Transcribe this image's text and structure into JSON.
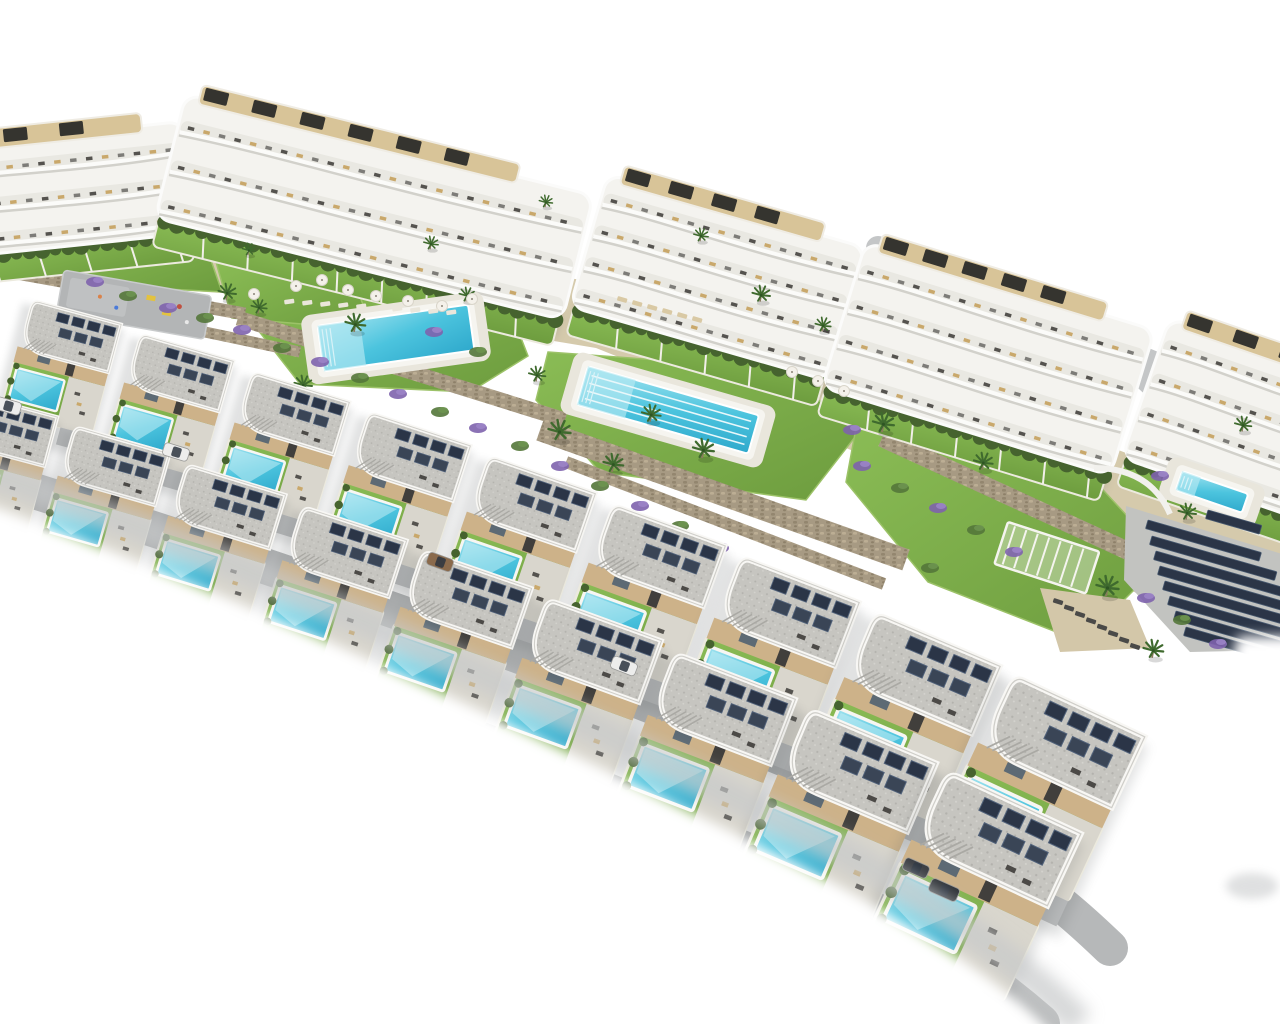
{
  "image": {
    "type": "aerial-3d-architectural-render",
    "subject": "Residential development: curved white apartment blocks at rear, two staggered rows of white villas with private turquoise pools in front, communal pools, lawns, palm trees, lavender beds, stone retaining walls and a solar panel array, all on a white background",
    "background": "#ffffff"
  },
  "palette": {
    "pool": "#3fbcd9",
    "poolLight": "#9fe2ef",
    "lawn": "#7cab47",
    "lawnDark": "#5f8f38",
    "hedge": "#46632f",
    "sand": "#d5caac",
    "stone": "#a79a83",
    "stoneDark": "#8d8069",
    "road": "#b6b8b9",
    "white": "#f4f3ef",
    "gravel": "#c6c5c0",
    "wallBeige": "#cdb289",
    "solar": "#2b3547",
    "purple": "#7e63ad",
    "palm": "#3f6a2e",
    "trunk": "#8a7a5e",
    "shadow": "#c7c9ca",
    "furniture": "#55534f",
    "woodTan": "#c9a86b",
    "deck": "#d8c498",
    "yellow": "#e3c23f",
    "carWhite": "#ededec",
    "carDark": "#3a3d42",
    "carVan": "#2f3338",
    "carBronze": "#8a6a4c"
  },
  "apartments": [
    {
      "x": -70,
      "y": 148,
      "w": 255,
      "h": 112,
      "rot": -6,
      "floors": 3,
      "pergolas": 3
    },
    {
      "x": 186,
      "y": 94,
      "w": 420,
      "h": 128,
      "rot": 14,
      "floors": 3,
      "pergolas": 6
    },
    {
      "x": 608,
      "y": 174,
      "w": 268,
      "h": 138,
      "rot": 16,
      "floors": 4,
      "pergolas": 4
    },
    {
      "x": 866,
      "y": 242,
      "w": 302,
      "h": 152,
      "rot": 17,
      "floors": 4,
      "pergolas": 5
    },
    {
      "x": 1170,
      "y": 318,
      "w": 225,
      "h": 148,
      "rot": 19,
      "floors": 4,
      "pergolas": 3
    }
  ],
  "villas": {
    "back": [
      {
        "x": 30,
        "y": 300,
        "s": 0.8,
        "rot": 15
      },
      {
        "x": 138,
        "y": 334,
        "s": 0.84,
        "rot": 16
      },
      {
        "x": 250,
        "y": 372,
        "s": 0.88,
        "rot": 17
      },
      {
        "x": 366,
        "y": 412,
        "s": 0.93,
        "rot": 18
      },
      {
        "x": 486,
        "y": 456,
        "s": 0.98,
        "rot": 19
      },
      {
        "x": 610,
        "y": 504,
        "s": 1.04,
        "rot": 20
      },
      {
        "x": 738,
        "y": 556,
        "s": 1.1,
        "rot": 21
      },
      {
        "x": 872,
        "y": 612,
        "s": 1.18,
        "rot": 23
      },
      {
        "x": 1010,
        "y": 674,
        "s": 1.26,
        "rot": 25
      }
    ],
    "front": [
      {
        "x": -36,
        "y": 392,
        "s": 0.82,
        "rot": 15
      },
      {
        "x": 72,
        "y": 426,
        "s": 0.86,
        "rot": 16
      },
      {
        "x": 184,
        "y": 464,
        "s": 0.9,
        "rot": 17
      },
      {
        "x": 300,
        "y": 506,
        "s": 0.95,
        "rot": 18
      },
      {
        "x": 420,
        "y": 550,
        "s": 1.0,
        "rot": 19
      },
      {
        "x": 544,
        "y": 598,
        "s": 1.06,
        "rot": 20
      },
      {
        "x": 672,
        "y": 652,
        "s": 1.12,
        "rot": 21
      },
      {
        "x": 806,
        "y": 708,
        "s": 1.2,
        "rot": 23
      },
      {
        "x": 944,
        "y": 770,
        "s": 1.28,
        "rot": 25
      }
    ]
  },
  "communal_pools": [
    {
      "cx": 396,
      "cy": 338,
      "w": 152,
      "h": 46,
      "rot": -8,
      "lanes": 0
    },
    {
      "cx": 668,
      "cy": 410,
      "w": 178,
      "h": 40,
      "rot": 16,
      "lanes": 4
    },
    {
      "cx": 1212,
      "cy": 492,
      "w": 70,
      "h": 20,
      "rot": 19,
      "lanes": 0
    }
  ],
  "pergola": {
    "x": 1008,
    "y": 522,
    "w": 96,
    "h": 44,
    "rot": 18
  },
  "playground": {
    "x": 64,
    "y": 270,
    "w": 150,
    "h": 44,
    "rot": 10
  },
  "solar_farm": {
    "rot": 16,
    "pad": [
      [
        1126,
        506
      ],
      [
        1282,
        554
      ],
      [
        1282,
        650
      ],
      [
        1190,
        652
      ],
      [
        1124,
        580
      ]
    ],
    "strips": [
      [
        1148,
        520,
        118
      ],
      [
        1152,
        536,
        130
      ],
      [
        1156,
        551,
        140
      ],
      [
        1160,
        566,
        146
      ],
      [
        1165,
        581,
        148
      ],
      [
        1170,
        596,
        140
      ],
      [
        1176,
        611,
        118
      ],
      [
        1186,
        627,
        84
      ],
      [
        1208,
        510,
        56
      ]
    ]
  },
  "walls": [
    {
      "x1": 0,
      "y1": 270,
      "x2": 245,
      "y2": 314,
      "w": 13
    },
    {
      "x1": 62,
      "y1": 302,
      "x2": 300,
      "y2": 352,
      "w": 11
    },
    {
      "x1": 238,
      "y1": 318,
      "x2": 565,
      "y2": 420,
      "w": 15
    },
    {
      "x1": 540,
      "y1": 430,
      "x2": 906,
      "y2": 560,
      "w": 22
    },
    {
      "x1": 566,
      "y1": 462,
      "x2": 884,
      "y2": 584,
      "w": 12
    },
    {
      "x1": 882,
      "y1": 438,
      "x2": 1152,
      "y2": 562,
      "w": 18
    },
    {
      "x1": 1134,
      "y1": 558,
      "x2": 1290,
      "y2": 648,
      "w": 15
    }
  ],
  "sand_band": [
    [
      0,
      222
    ],
    [
      300,
      236
    ],
    [
      620,
      286
    ],
    [
      900,
      366
    ],
    [
      1160,
      466
    ],
    [
      1280,
      526
    ],
    [
      1280,
      666
    ],
    [
      1146,
      598
    ],
    [
      896,
      468
    ],
    [
      596,
      348
    ],
    [
      296,
      298
    ],
    [
      0,
      278
    ]
  ],
  "sand_patches": [
    [
      [
        1040,
        588
      ],
      [
        1130,
        600
      ],
      [
        1150,
        648
      ],
      [
        1060,
        652
      ]
    ]
  ],
  "lawns": [
    [
      [
        272,
        290
      ],
      [
        500,
        284
      ],
      [
        528,
        356
      ],
      [
        470,
        392
      ],
      [
        300,
        384
      ],
      [
        258,
        330
      ]
    ],
    [
      [
        548,
        352
      ],
      [
        768,
        368
      ],
      [
        862,
        428
      ],
      [
        806,
        500
      ],
      [
        600,
        472
      ],
      [
        536,
        400
      ]
    ],
    [
      [
        856,
        428
      ],
      [
        1092,
        478
      ],
      [
        1166,
        558
      ],
      [
        1082,
        642
      ],
      [
        928,
        582
      ],
      [
        846,
        482
      ]
    ],
    [
      [
        216,
        262
      ],
      [
        352,
        274
      ],
      [
        372,
        330
      ],
      [
        232,
        318
      ]
    ],
    [
      [
        56,
        232
      ],
      [
        206,
        246
      ],
      [
        222,
        292
      ],
      [
        72,
        284
      ]
    ]
  ],
  "roads": [
    {
      "d": "M-40,468 C260,560 560,664 860,790 C1000,848 1060,900 1110,948",
      "w": 36,
      "c": "#b6b8b9",
      "layer": "front"
    },
    {
      "d": "M-40,556 C260,652 540,760 800,876 C920,930 990,980 1040,1024",
      "w": 40,
      "c": "#b6b8b9",
      "layer": "front"
    },
    {
      "d": "M878,248 L1290,420",
      "w": 24,
      "c": "#c4c6c7",
      "layer": "back"
    },
    {
      "d": "M1118,356 L1246,474",
      "w": 20,
      "c": "#c4c6c7",
      "layer": "back"
    }
  ],
  "palms": [
    [
      226,
      298,
      0.8
    ],
    [
      258,
      312,
      0.7
    ],
    [
      354,
      330,
      0.9
    ],
    [
      302,
      390,
      0.8
    ],
    [
      430,
      248,
      0.65
    ],
    [
      545,
      206,
      0.6
    ],
    [
      558,
      438,
      1
    ],
    [
      612,
      470,
      0.9
    ],
    [
      650,
      420,
      0.85
    ],
    [
      702,
      456,
      0.95
    ],
    [
      536,
      380,
      0.75
    ],
    [
      760,
      300,
      0.8
    ],
    [
      822,
      330,
      0.7
    ],
    [
      882,
      430,
      0.95
    ],
    [
      982,
      468,
      0.85
    ],
    [
      1106,
      594,
      1
    ],
    [
      1152,
      656,
      0.9
    ],
    [
      1186,
      518,
      0.8
    ],
    [
      248,
      254,
      0.6
    ],
    [
      1242,
      430,
      0.75
    ],
    [
      466,
      300,
      0.7
    ],
    [
      700,
      240,
      0.65
    ]
  ],
  "plants": [
    [
      95,
      282,
      "p"
    ],
    [
      128,
      296,
      "g"
    ],
    [
      168,
      308,
      "p"
    ],
    [
      205,
      318,
      "g"
    ],
    [
      242,
      330,
      "p"
    ],
    [
      282,
      348,
      "g"
    ],
    [
      320,
      362,
      "p"
    ],
    [
      360,
      378,
      "g"
    ],
    [
      398,
      394,
      "p"
    ],
    [
      440,
      412,
      "g"
    ],
    [
      478,
      428,
      "p"
    ],
    [
      520,
      446,
      "g"
    ],
    [
      560,
      466,
      "p"
    ],
    [
      600,
      486,
      "g"
    ],
    [
      640,
      506,
      "p"
    ],
    [
      680,
      526,
      "g"
    ],
    [
      720,
      548,
      "p"
    ],
    [
      762,
      570,
      "g"
    ],
    [
      800,
      590,
      "p"
    ],
    [
      862,
      466,
      "p"
    ],
    [
      900,
      488,
      "g"
    ],
    [
      938,
      508,
      "p"
    ],
    [
      976,
      530,
      "g"
    ],
    [
      1014,
      552,
      "p"
    ],
    [
      1146,
      598,
      "p"
    ],
    [
      1182,
      620,
      "g"
    ],
    [
      1218,
      644,
      "p"
    ],
    [
      434,
      332,
      "p"
    ],
    [
      478,
      352,
      "g"
    ],
    [
      852,
      430,
      "p"
    ],
    [
      1160,
      476,
      "p"
    ],
    [
      930,
      568,
      "g"
    ]
  ],
  "parasols": [
    [
      296,
      286
    ],
    [
      322,
      280
    ],
    [
      348,
      290
    ],
    [
      376,
      296
    ],
    [
      408,
      301
    ],
    [
      442,
      306
    ],
    [
      472,
      299
    ],
    [
      254,
      294
    ],
    [
      792,
      372
    ],
    [
      818,
      381
    ],
    [
      844,
      391
    ]
  ],
  "lounger_rows": [
    {
      "x": 284,
      "y": 300,
      "n": 10,
      "dx": 18,
      "dy": 1.2,
      "rot": -8,
      "c": "#eae6db"
    },
    {
      "x": 618,
      "y": 296,
      "n": 6,
      "dx": 15,
      "dy": 4,
      "rot": 16,
      "c": "#d9c9a4"
    },
    {
      "x": 1054,
      "y": 598,
      "n": 8,
      "dx": 11,
      "dy": 6.4,
      "rot": 18,
      "c": "#4a4a48"
    }
  ],
  "cars": [
    {
      "x": 8,
      "y": 406,
      "rot": 16,
      "t": "white"
    },
    {
      "x": 176,
      "y": 452,
      "rot": 17,
      "t": "white"
    },
    {
      "x": 440,
      "y": 562,
      "rot": 20,
      "t": "bronze"
    },
    {
      "x": 624,
      "y": 666,
      "rot": 21,
      "t": "white"
    },
    {
      "x": 916,
      "y": 868,
      "rot": 24,
      "t": "dark"
    },
    {
      "x": 944,
      "y": 890,
      "rot": 24,
      "t": "van"
    }
  ],
  "curved_wall": {
    "d": "M1094,468 Q1150,468 1170,514"
  },
  "fade": {
    "edge": "M-20,470 C250,560 520,690 780,820 C940,898 1040,980 1080,1024",
    "coverBottom": "M-30,498 C250,598 520,726 780,856 C940,934 1030,1006 1058,1040 L-30,1040 Z",
    "coverRight": "M1238,636 C1204,758 1158,898 1114,1040 L1300,1040 L1300,636 Z",
    "smudge": {
      "x": 1252,
      "y": 886,
      "rx": 26,
      "ry": 13,
      "o": 0.45
    }
  }
}
